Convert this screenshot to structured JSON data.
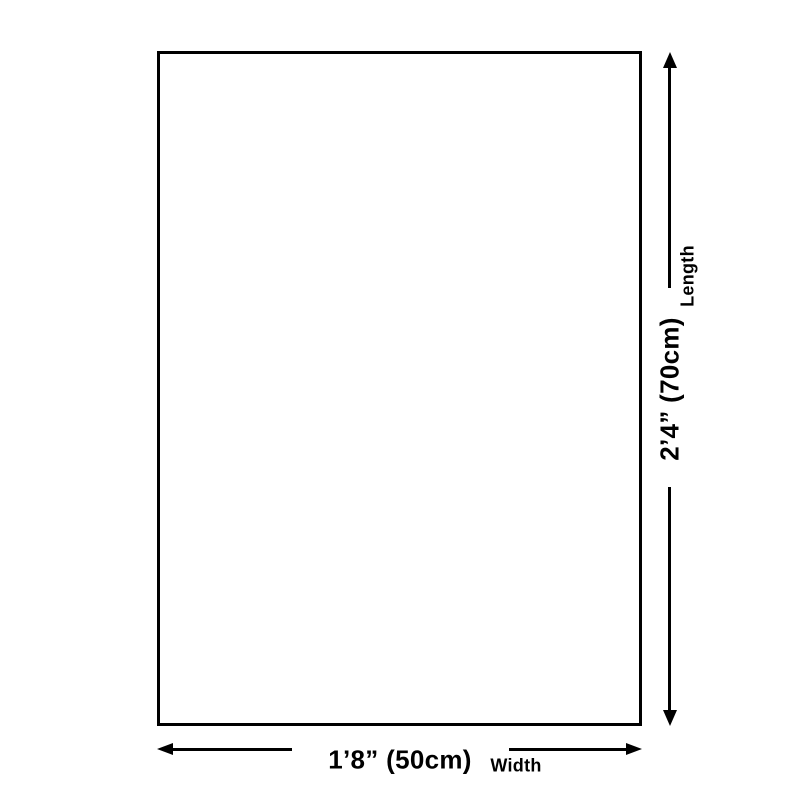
{
  "diagram": {
    "background_color": "#ffffff",
    "line_color": "#000000",
    "text_color": "#000000",
    "shape": "rectangle-outline",
    "length_dimension": {
      "value": "2’4” (70cm)",
      "label": "Length",
      "orientation": "vertical"
    },
    "width_dimension": {
      "value": "1’8” (50cm)",
      "label": "Width",
      "orientation": "horizontal"
    }
  }
}
